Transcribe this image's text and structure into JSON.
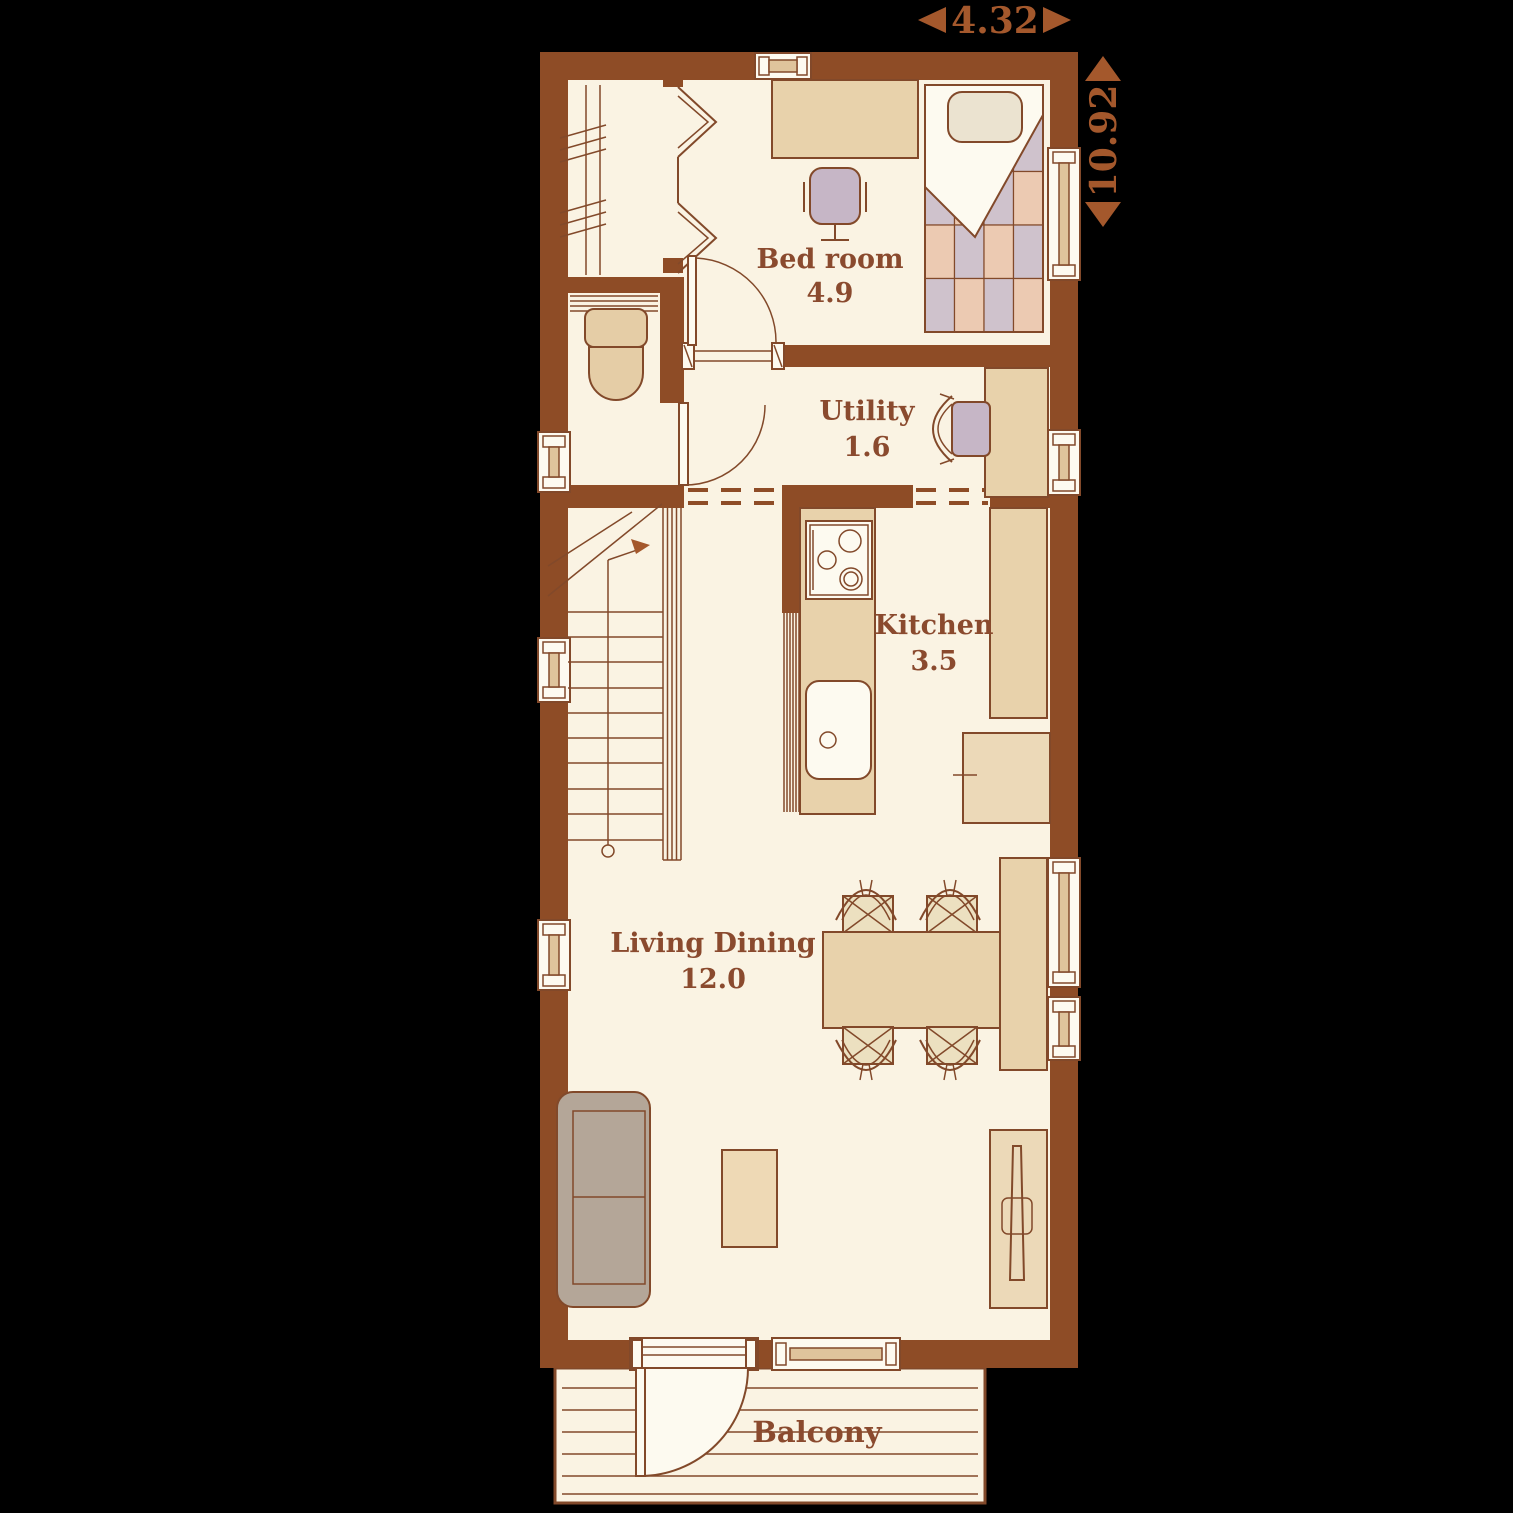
{
  "plan": {
    "type": "residential-floor-plan",
    "dimensions": {
      "horizontal": "4.32",
      "vertical": "10.92"
    },
    "rooms": [
      {
        "name": "Bed room",
        "size": "4.9"
      },
      {
        "name": "Utility",
        "size": "1.6"
      },
      {
        "name": "Kitchen",
        "size": "3.5"
      },
      {
        "name": "Living Dining",
        "size": "12.0"
      },
      {
        "name": "Balcony"
      }
    ],
    "colors": {
      "background": "#000000",
      "wall": "#8e4c26",
      "outline": "#82492a",
      "floor": "#faf3e3",
      "furniture_tan": "#e8d2ab",
      "label_text": "#8a4a2e",
      "dimension_text": "#a4582c",
      "quilt_pink": "#eccab2",
      "quilt_lavender": "#cfc2cc",
      "sofa_gray": "#b4a698",
      "chair_lavender": "#c6b6c6"
    }
  }
}
